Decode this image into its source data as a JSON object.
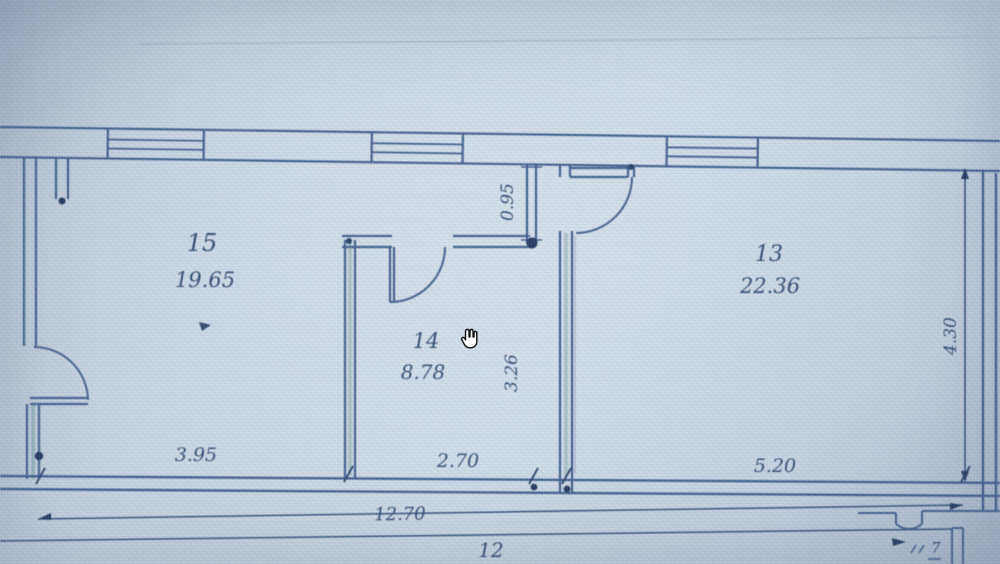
{
  "viewer": {
    "cursor": "open-hand",
    "accent_line_color": "#3d5f92",
    "teal_fringe_color": "#3f8276",
    "text_color": "#2e4c78",
    "background_color": "#c6d4e3"
  },
  "plan": {
    "rooms": [
      {
        "number": "15",
        "area": "19.65"
      },
      {
        "number": "14",
        "area": "8.78"
      },
      {
        "number": "13",
        "area": "22.36"
      }
    ],
    "dimensions": {
      "bottom_left": "3.95",
      "bottom_middle": "2.70",
      "bottom_right": "5.20",
      "bottom_total": "12.70",
      "bottom_overall": "12",
      "nib_height": "0.95",
      "room14_depth": "3.26",
      "room13_depth": "4.30",
      "corner_partial": "7"
    }
  }
}
